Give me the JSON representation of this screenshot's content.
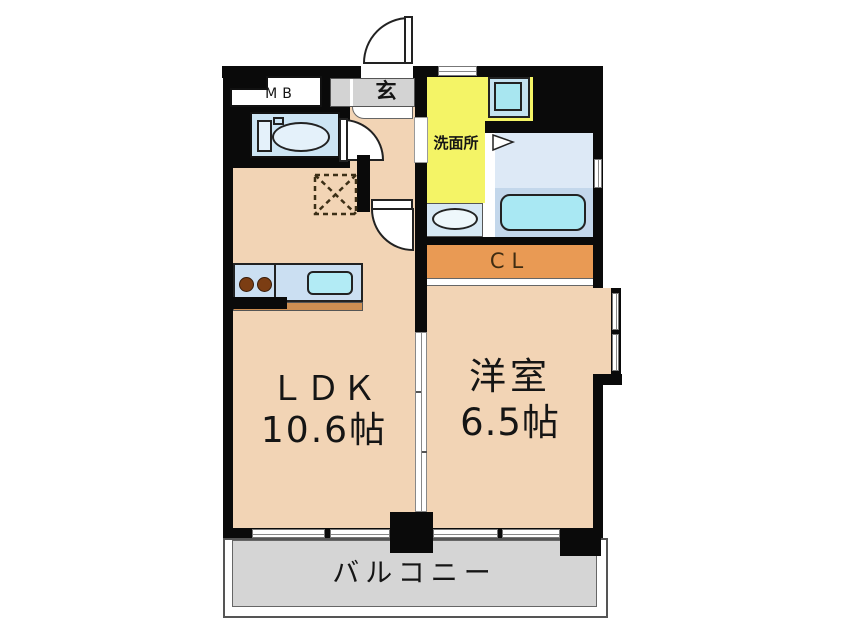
{
  "floor_plan": {
    "labels": {
      "meter_box": "MB",
      "entrance": "玄",
      "washroom": "洗面所",
      "closet": "CL",
      "ldk_name": "ＬＤＫ",
      "ldk_size": "10.6帖",
      "western_room_name": "洋室",
      "western_room_size": "6.5帖",
      "balcony": "バルコニー"
    },
    "colors": {
      "wall": "#0a0a0a",
      "room_floor": "#f2d4b5",
      "washroom_yellow": "#f4f466",
      "closet_orange": "#e99a54",
      "balcony_gray": "#d5d5d5",
      "entrance_gray": "#d3d3d3",
      "toilet_blue": "#cde5f4",
      "bathroom_blue": "#dde9f6",
      "bathtub_cyan": "#a9e8f3",
      "kitchen_counter_blue": "#cbdff2"
    }
  }
}
